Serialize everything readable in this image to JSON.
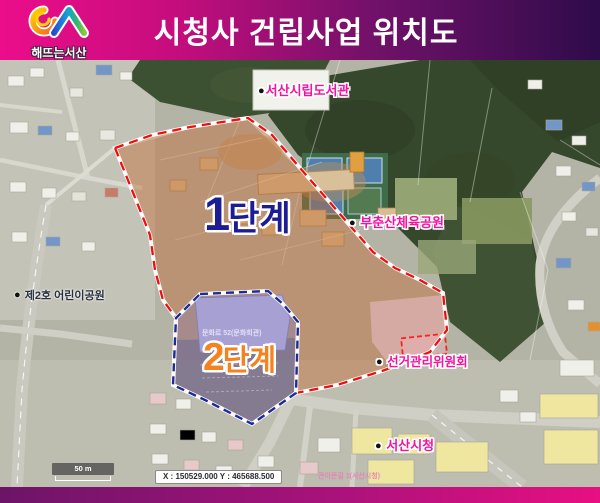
{
  "header": {
    "logo_text": "해뜨는서산",
    "title": "시청사 건립사업 위치도"
  },
  "map": {
    "phase1": {
      "num": "1",
      "suffix": "단계"
    },
    "phase2": {
      "num": "2",
      "suffix": "단계"
    },
    "labels": {
      "library": {
        "bullet": "●",
        "text": "서산시립도서관"
      },
      "sports_park": {
        "bullet": "●",
        "text": "부춘산체육공원"
      },
      "election_commission": {
        "bullet": "●",
        "text": "선거관리위원회"
      },
      "city_hall": {
        "bullet": "●",
        "text": "서산시청"
      },
      "children_park": {
        "bullet": "●",
        "text": "제2호 어린이공원"
      }
    },
    "micro_labels": {
      "culture_center": "문화로 52(문화회관)",
      "city_hall_road": "관아문길 1(서산시청)"
    },
    "scale_text": "50 m",
    "coordinates_text": "X : 150529.000 Y : 465688.500"
  },
  "colors": {
    "header_gradient_left": "#ec0d8a",
    "header_gradient_right": "#2e0b4a",
    "phase1_outline": "#f00d0d",
    "phase1_fill": "#c1672d",
    "phase1_label": "#1c1c94",
    "phase2_outline": "#1d2b99",
    "phase2_fill": "#7e7cc0",
    "phase2_label": "#f5821e",
    "poi_label": "#f8109e",
    "footer_gradient_left": "#6d1468",
    "footer_gradient_right": "#e80f82"
  }
}
